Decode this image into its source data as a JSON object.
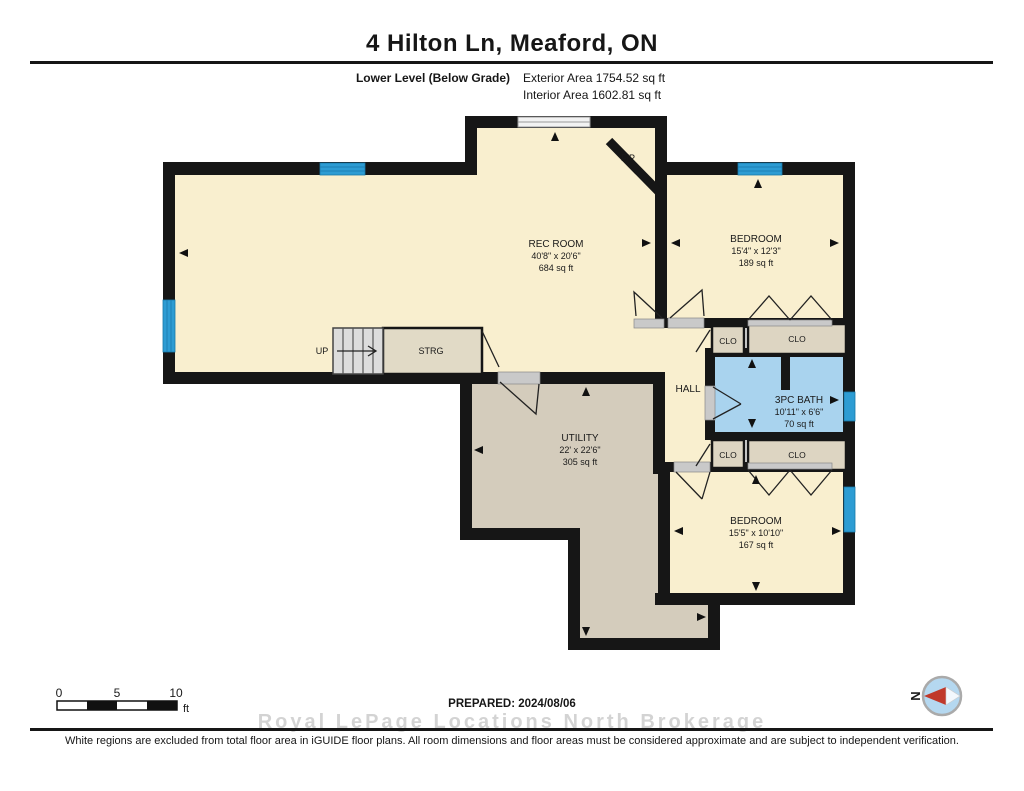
{
  "header": {
    "title": "4 Hilton Ln, Meaford, ON",
    "level_label": "Lower Level (Below Grade)",
    "exterior_area": "Exterior Area 1754.52 sq ft",
    "interior_area": "Interior Area 1602.81 sq ft"
  },
  "plan": {
    "rooms": [
      {
        "id": "rec-room",
        "name": "REC ROOM",
        "dims": "40'8\" x 20'6\"",
        "area": "684 sq ft"
      },
      {
        "id": "bedroom-top",
        "name": "BEDROOM",
        "dims": "15'4\" x 12'3\"",
        "area": "189 sq ft"
      },
      {
        "id": "bath",
        "name": "3PC BATH",
        "dims": "10'11\" x 6'6\"",
        "area": "70 sq ft"
      },
      {
        "id": "utility",
        "name": "UTILITY",
        "dims": "22' x 22'6\"",
        "area": "305 sq ft"
      },
      {
        "id": "bedroom-bottom",
        "name": "BEDROOM",
        "dims": "15'5\" x 10'10\"",
        "area": "167 sq ft"
      },
      {
        "id": "hall",
        "name": "HALL"
      },
      {
        "id": "storage",
        "name": "STRG"
      }
    ],
    "labels": {
      "closet": "CLO",
      "stairs_up": "UP",
      "fireplace": "F/P"
    }
  },
  "footer": {
    "scale": {
      "ticks": [
        "0",
        "5",
        "10"
      ],
      "unit": "ft"
    },
    "prepared": "PREPARED: 2024/08/06",
    "compass_north": "N",
    "watermark": "Royal LePage Locations North Brokerage",
    "disclaimer": "White regions are excluded from total floor area in iGUIDE floor plans. All room dimensions and floor areas must be considered approximate and are subject to independent verification."
  },
  "colors": {
    "room_cream": "#f9efcf",
    "utility_tan": "#d4ccbc",
    "closet_tan": "#ddd5c2",
    "bath_blue": "#a9d3ee",
    "window_blue": "#2d9cd3",
    "wall_black": "#161616"
  }
}
